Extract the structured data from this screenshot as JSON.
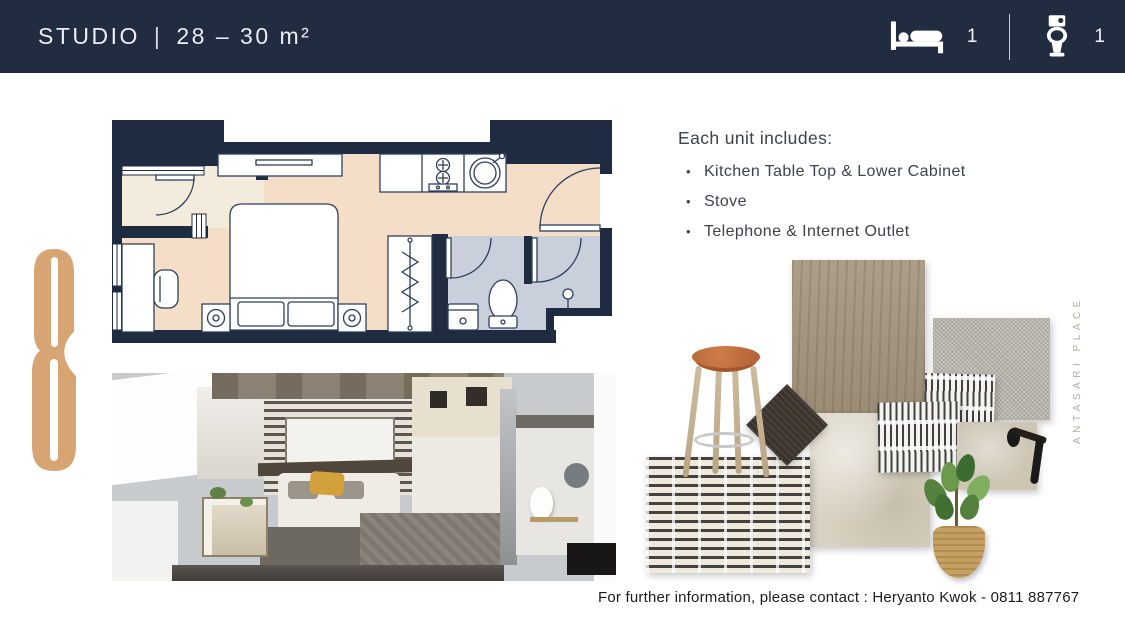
{
  "theme": {
    "header_bg": "#212C40",
    "header_text": "#E9ECF2",
    "wall": "#1F2B40",
    "floor": "#F5DEC7",
    "foyer": "#F3EBDB",
    "wet": "#CAD0DB",
    "logo": "#D7A474",
    "watermark": "#B3ACA1",
    "text": "#3C424E",
    "contact": "#1B1B1B"
  },
  "header": {
    "unit_type": "STUDIO",
    "divider": "|",
    "area": "28 – 30 m²",
    "stats": [
      {
        "icon": "bed-icon",
        "value": "1"
      },
      {
        "icon": "toilet-icon",
        "value": "1"
      }
    ]
  },
  "includes": {
    "heading": "Each unit includes:",
    "bullet": "•",
    "items": [
      "Kitchen Table Top & Lower Cabinet",
      "Stove",
      "Telephone & Internet Outlet"
    ]
  },
  "branding": {
    "vertical_watermark": "ANTASARI PLACE",
    "monogram": "stylized-8-monogram"
  },
  "footer": {
    "contact": "For further information, please contact : Heryanto Kwok - 0811 887767"
  },
  "figures": {
    "floor_plan": "studio-unit-floor-plan",
    "render": "studio-unit-3d-cutaway-render",
    "material_board": [
      "wood-laminate-panel",
      "grey-fabric-swatch",
      "beige-stone-slab",
      "striped-tile-swatch",
      "dark-oak-swatch",
      "patterned-rug",
      "bar-stool",
      "door-handle-tile",
      "potted-plant"
    ]
  }
}
